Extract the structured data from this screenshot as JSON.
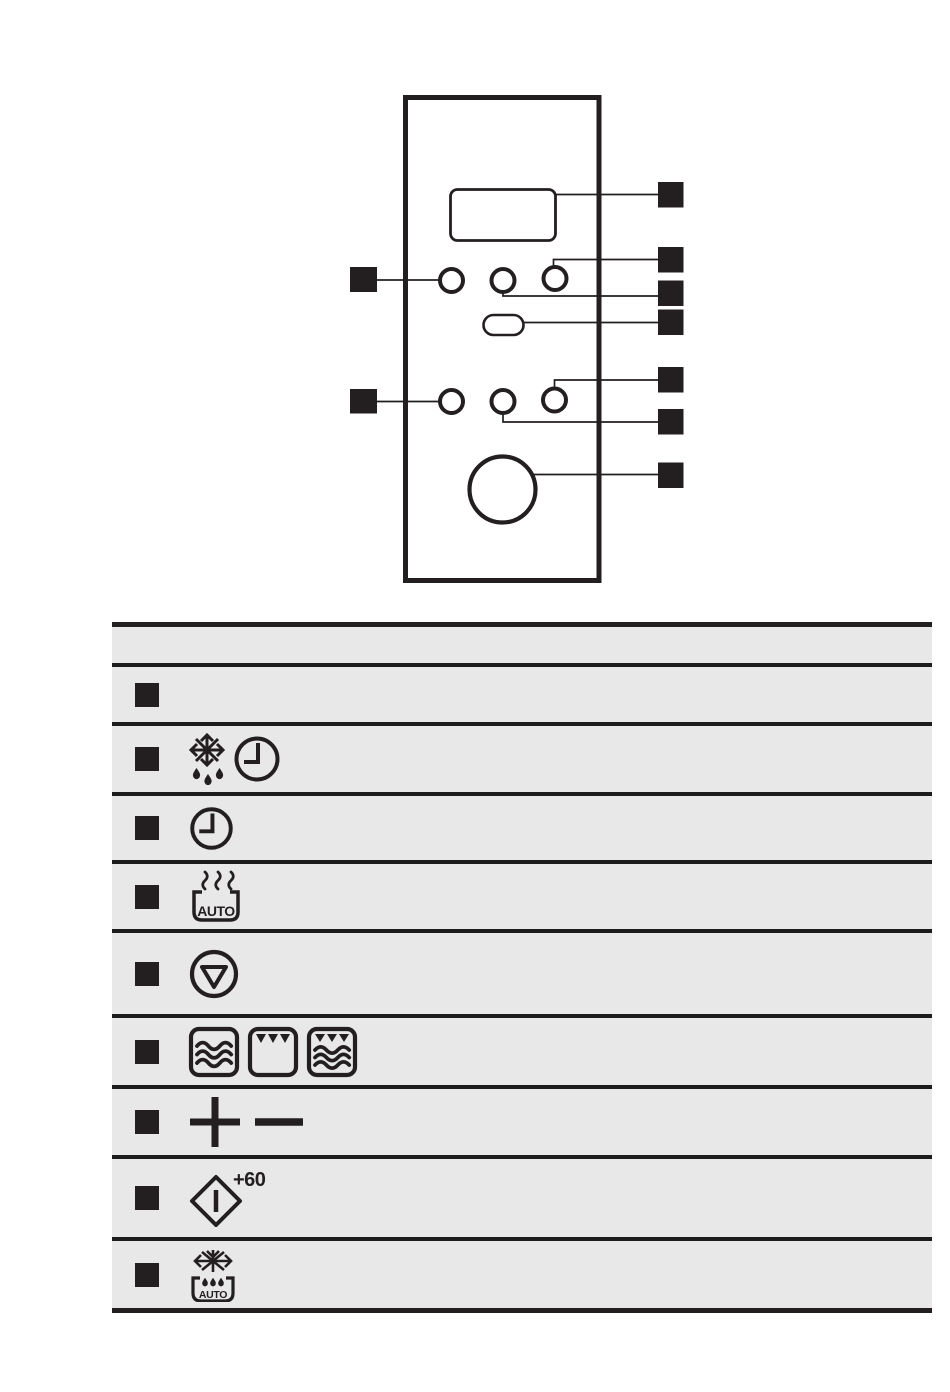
{
  "colors": {
    "ink": "#231f20",
    "table_background": "#e8e8e8",
    "divider_line": "#1c1c1c",
    "page_background": "#ffffff"
  },
  "panel_diagram": {
    "description": "control panel callout drawing",
    "parts": [
      "display-window",
      "top-button-row-3-buttons",
      "stop-pill-button",
      "bottom-button-row-3-buttons",
      "rotary-dial"
    ],
    "left_callout_count": 2,
    "right_callout_count": 7
  },
  "legend_table": {
    "header": {
      "label": ""
    },
    "rows": [
      {
        "icons": [],
        "label": ""
      },
      {
        "icons": [
          "snowflake-drip-icon",
          "clock-icon"
        ],
        "label": ""
      },
      {
        "icons": [
          "clock-icon"
        ],
        "label": ""
      },
      {
        "icons": [
          "steam-auto-icon"
        ],
        "label": "AUTO"
      },
      {
        "icons": [
          "stop-icon"
        ],
        "label": ""
      },
      {
        "icons": [
          "microwave-icon",
          "grill-icon",
          "grill-microwave-icon"
        ],
        "label": ""
      },
      {
        "icons": [
          "plus-icon",
          "minus-icon"
        ],
        "label": ""
      },
      {
        "icons": [
          "start-plus-60-icon"
        ],
        "label": "+60"
      },
      {
        "icons": [
          "auto-defrost-icon"
        ],
        "label": "AUTO"
      }
    ]
  }
}
